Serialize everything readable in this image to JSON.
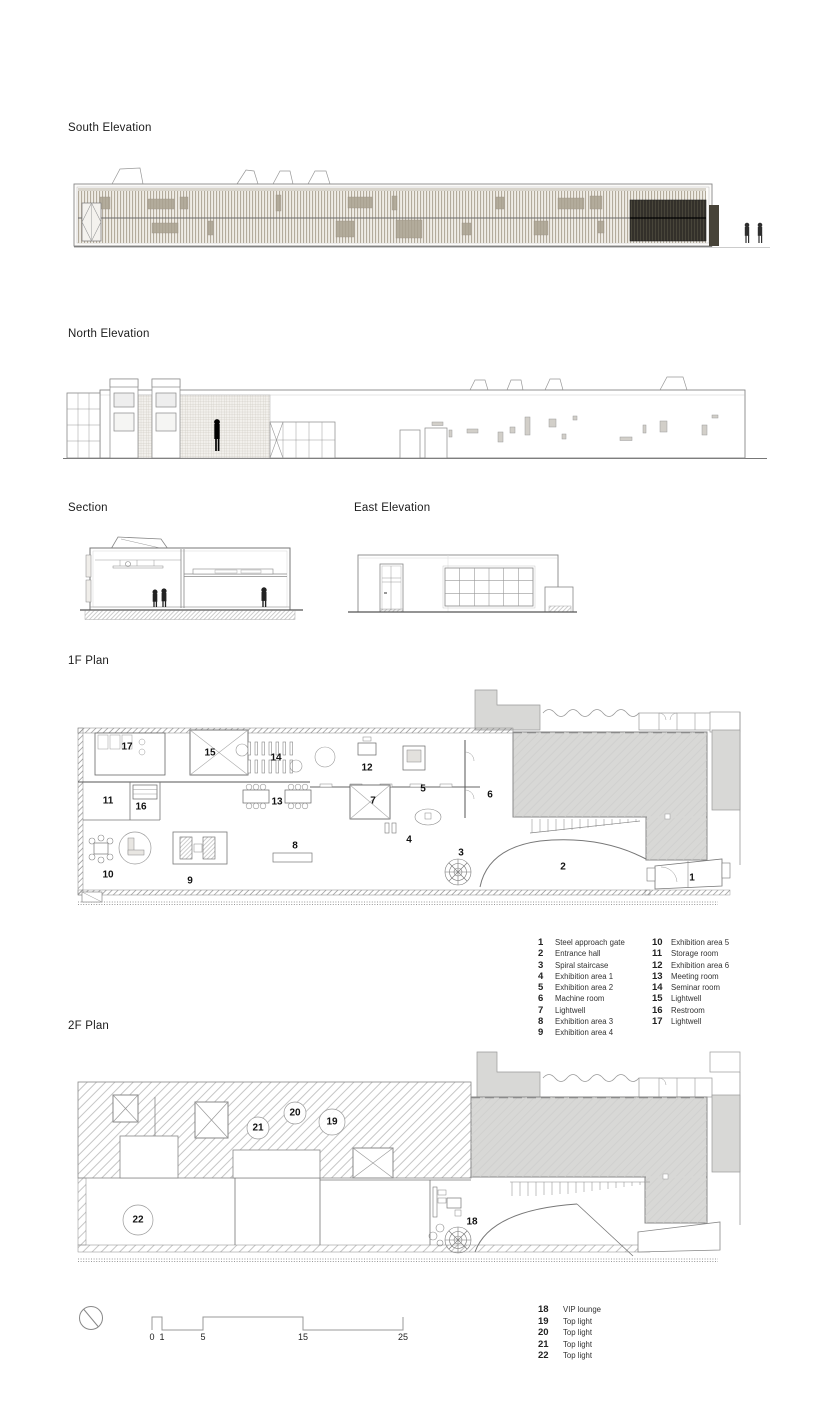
{
  "titles": {
    "south_elevation": "South Elevation",
    "north_elevation": "North Elevation",
    "section": "Section",
    "east_elevation": "East Elevation",
    "plan_1f": "1F Plan",
    "plan_2f": "2F Plan"
  },
  "legend_1f": {
    "col1": [
      {
        "num": "1",
        "label": "Steel approach gate"
      },
      {
        "num": "2",
        "label": "Entrance hall"
      },
      {
        "num": "3",
        "label": "Spiral staircase"
      },
      {
        "num": "4",
        "label": "Exhibition area 1"
      },
      {
        "num": "5",
        "label": "Exhibition area 2"
      },
      {
        "num": "6",
        "label": "Machine room"
      },
      {
        "num": "7",
        "label": "Lightwell"
      },
      {
        "num": "8",
        "label": "Exhibition area 3"
      },
      {
        "num": "9",
        "label": "Exhibition area 4"
      }
    ],
    "col2": [
      {
        "num": "10",
        "label": "Exhibition area 5"
      },
      {
        "num": "11",
        "label": "Storage room"
      },
      {
        "num": "12",
        "label": "Exhibition area 6"
      },
      {
        "num": "13",
        "label": "Meeting room"
      },
      {
        "num": "14",
        "label": "Seminar room"
      },
      {
        "num": "15",
        "label": "Lightwell"
      },
      {
        "num": "16",
        "label": "Restroom"
      },
      {
        "num": "17",
        "label": "Lightwell"
      }
    ]
  },
  "legend_2f": [
    {
      "num": "18",
      "label": "VIP lounge"
    },
    {
      "num": "19",
      "label": "Top light"
    },
    {
      "num": "20",
      "label": "Top light"
    },
    {
      "num": "21",
      "label": "Top light"
    },
    {
      "num": "22",
      "label": "Top light"
    }
  ],
  "plan_1f": {
    "numbers": [
      {
        "num": "1"
      },
      {
        "num": "2"
      },
      {
        "num": "3"
      },
      {
        "num": "4"
      },
      {
        "num": "5"
      },
      {
        "num": "6"
      },
      {
        "num": "7"
      },
      {
        "num": "8"
      },
      {
        "num": "9"
      },
      {
        "num": "10"
      },
      {
        "num": "11"
      },
      {
        "num": "12"
      },
      {
        "num": "13"
      },
      {
        "num": "14"
      },
      {
        "num": "15"
      },
      {
        "num": "16"
      },
      {
        "num": "17"
      }
    ]
  },
  "plan_2f": {
    "numbers": [
      {
        "num": "18"
      },
      {
        "num": "19"
      },
      {
        "num": "20"
      },
      {
        "num": "21"
      },
      {
        "num": "22"
      }
    ]
  },
  "scale_bar": {
    "ticks": [
      "0",
      "1",
      "5",
      "15",
      "25"
    ]
  },
  "colors": {
    "batten": "#b3ab9c",
    "dark_panel": "#33302a",
    "plan_fill": "#d8d8d6",
    "line": "#8a8a8a",
    "text": "#111111"
  }
}
